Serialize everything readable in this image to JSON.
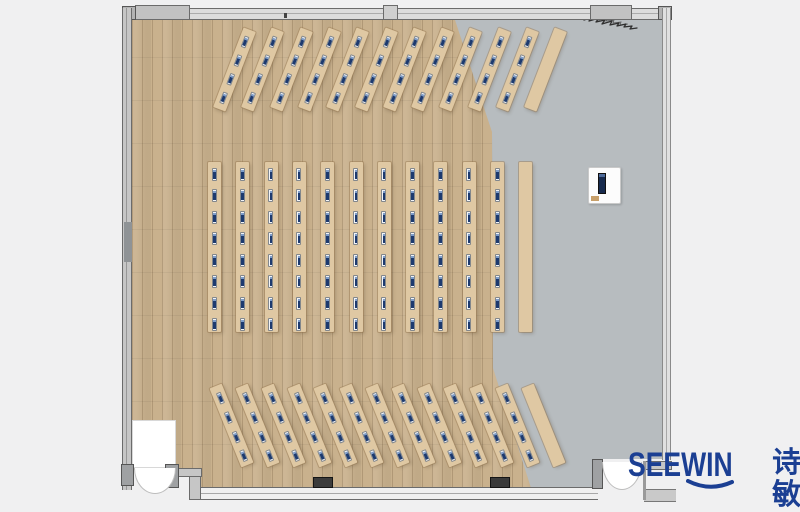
{
  "brand": {
    "logo_text": "SEEWIN",
    "logo_cjk": "诗敏"
  },
  "colors": {
    "page_bg": "#f0f0f1",
    "wood": "#c9b18d",
    "gray_floor": "#b7bcbf",
    "desk": "#dfc8a3",
    "wall_dark": "#6b6b6b",
    "monitor_navy": "#1d3a6f",
    "monitor_light": "#7d9cc9",
    "monitor_white": "#f3f4f6",
    "pillar": "#3b3b3b",
    "door_white": "#ffffff",
    "logo_blue": "#1b3f93",
    "scribble": "#2f2f2f"
  },
  "floorplan": {
    "room_label": "training-room-plan",
    "sections": [
      {
        "id": "top",
        "orientation": "angled-right",
        "angle": 21,
        "strips": 12,
        "monitors_per_strip": 4,
        "plain_last": true
      },
      {
        "id": "middle",
        "orientation": "vertical",
        "angle": 0,
        "strips": 12,
        "monitors_per_strip": 8,
        "plain_last": true
      },
      {
        "id": "bottom",
        "orientation": "angled-left",
        "angle": -22,
        "strips": 13,
        "monitors_per_strip": 4,
        "plain_last": true
      }
    ],
    "features": [
      {
        "id": "podium",
        "type": "lectern"
      },
      {
        "id": "entrance-left",
        "type": "double-door"
      },
      {
        "id": "entrance-right",
        "type": "double-door"
      },
      {
        "id": "scribble",
        "type": "annotation"
      }
    ]
  }
}
